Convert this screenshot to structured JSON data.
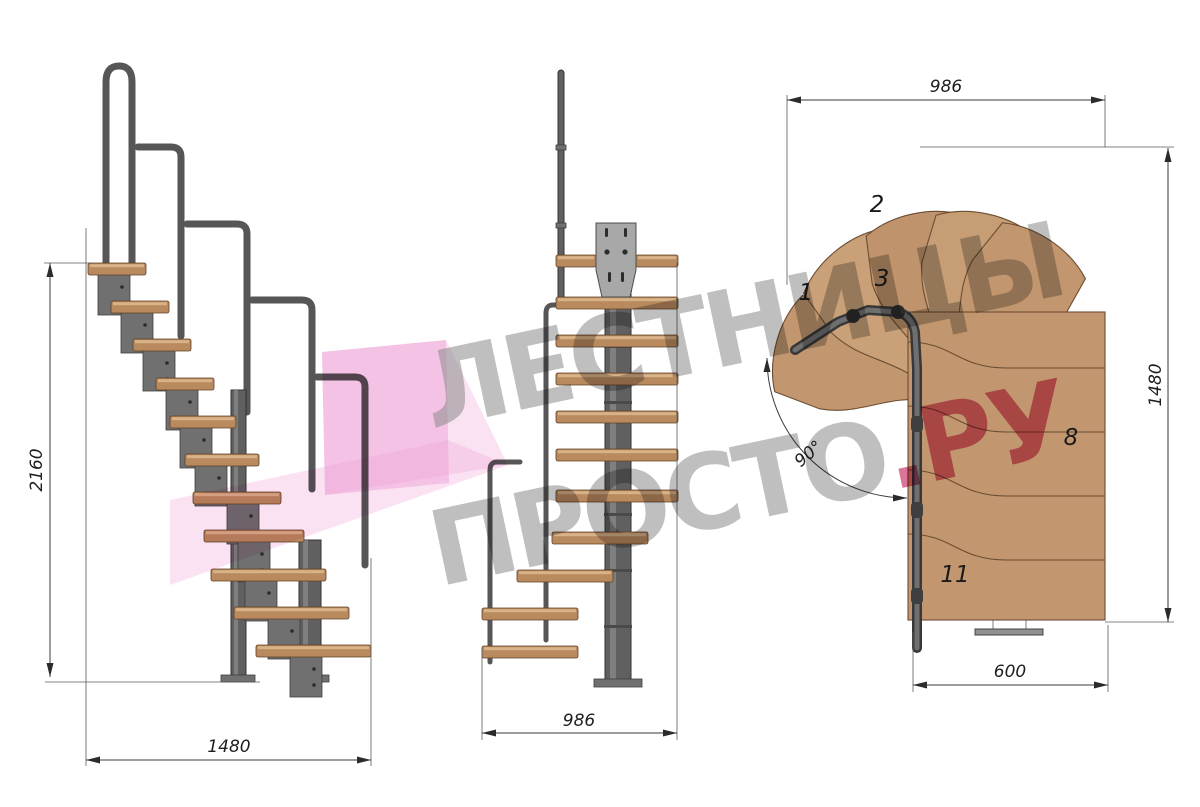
{
  "watermark": {
    "line1": "ЛЕСТНИЦЫ",
    "line2_gray": "ПРОСТО",
    "line2_red": ".РУ"
  },
  "views": {
    "side": {
      "dim_height": "2160",
      "dim_width": "1480"
    },
    "front": {
      "dim_width": "986"
    },
    "plan": {
      "dim_width_top": "986",
      "dim_height_right": "1480",
      "dim_width_bottom": "600",
      "turn_angle": "90°",
      "step_numbers": {
        "s1": "1",
        "s2": "2",
        "s3": "3",
        "s8": "8",
        "s11": "11"
      }
    }
  },
  "colors": {
    "background": "#ffffff",
    "wood": "#c2976f",
    "wood_dark_edge": "#6b4d32",
    "tread_side": "#b98a5e",
    "metal": "#707070",
    "metal_dark": "#3e3e3e",
    "rail": "#565656",
    "dimension": "#2b2b2b",
    "watermark_gray": "#8a8a8a",
    "watermark_red": "#c6205c",
    "watermark_pink": "#ee9fd5"
  }
}
